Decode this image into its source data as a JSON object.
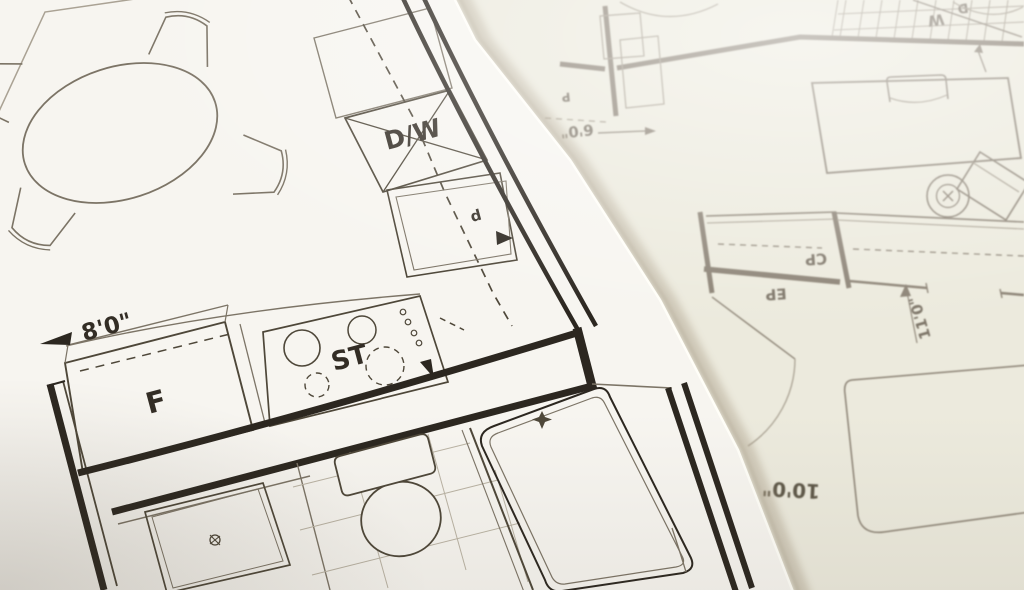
{
  "colors": {
    "paper_left": "#f7f5f0",
    "paper_right": "#eceadd",
    "ink_dark": "#2c2720",
    "ink_mid": "#4e4739",
    "ink_light": "#7c7466",
    "ink_faint": "#aaa294",
    "right_ink": "#8b8274",
    "right_ink_light": "#a59d8e",
    "shadow": "#ab9f89",
    "tile": "#bab3a4",
    "label": "#332d25",
    "right_label": "#7d7568",
    "rug_label": "#5f5849"
  },
  "labels": {
    "left": {
      "dishwasher": "D/W",
      "stove": "ST",
      "fridge": "F",
      "sink_letter": "d",
      "width_dim": "8'0\""
    },
    "right": {
      "closet_cp": "CP",
      "closet_ep": "EP",
      "bedroom_dim": "11'0\"",
      "rug_dim": "10'0\"",
      "door_dim": "6'0\"",
      "washer": "W",
      "dryer": "D",
      "pantry_letter": "P"
    }
  }
}
